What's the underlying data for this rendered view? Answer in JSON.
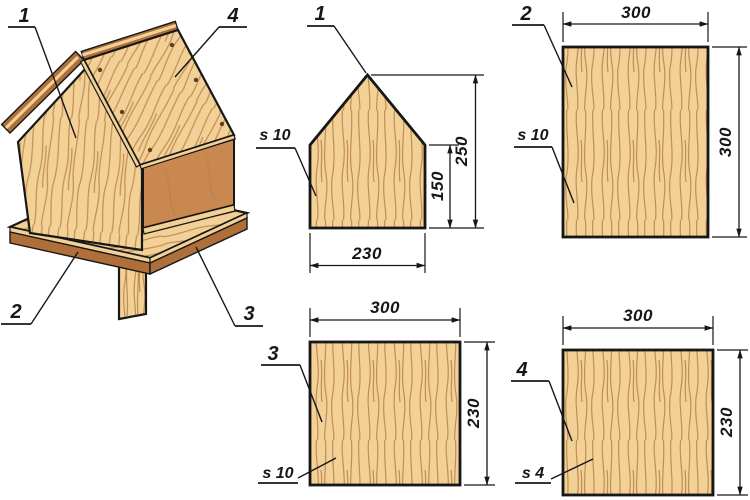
{
  "assembly": {
    "callouts": {
      "wall": "1",
      "roof": "4",
      "base": "2",
      "tray": "3"
    }
  },
  "parts": {
    "p1": {
      "callout": "1",
      "thickness": "s 10",
      "dim_bottom": "230",
      "dim_side": "150",
      "dim_total": "250"
    },
    "p2": {
      "callout": "2",
      "thickness": "s 10",
      "dim_top": "300",
      "dim_right": "300"
    },
    "p3": {
      "callout": "3",
      "thickness": "s 10",
      "dim_top": "300",
      "dim_right": "230"
    },
    "p4": {
      "callout": "4",
      "thickness": "s 4",
      "dim_top": "300",
      "dim_right": "230"
    }
  },
  "colors": {
    "background": "#ffffff",
    "wood_light": "#f2d096",
    "wood_grain": "#b5824a",
    "wood_dark": "#ae6f3a",
    "wood_interior": "#c9884f",
    "line": "#171717",
    "screw": "#5f3d1f"
  }
}
